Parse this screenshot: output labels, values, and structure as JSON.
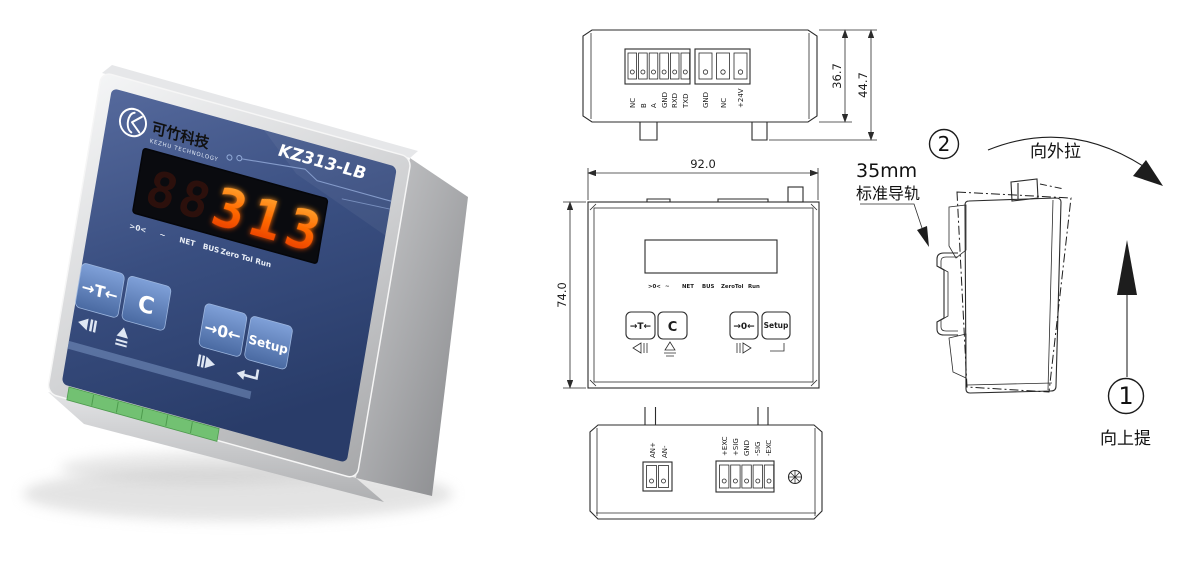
{
  "product": {
    "brand_cn": "可竹科技",
    "brand_en": "KEZHU TECHNOLOGY",
    "model": "KZ313-LB",
    "display_ghost": "88",
    "display_value": "313",
    "indicators": [
      ">0<",
      "~",
      "NET",
      "BUS",
      "Zero Tol",
      "Run"
    ],
    "buttons": {
      "tare": "→T←",
      "clear": "C",
      "zero": "→0←",
      "setup": "Setup"
    }
  },
  "top_view": {
    "terminals_comm": [
      "NC",
      "B",
      "A",
      "GND",
      "RXD",
      "TXD"
    ],
    "terminals_power": [
      "GND",
      "NC",
      "+24V"
    ],
    "dim_body_height": "36.7",
    "dim_total_height": "44.7"
  },
  "front_view": {
    "dim_width": "92.0",
    "dim_height": "74.0",
    "indicators": [
      ">0<",
      "~",
      "NET",
      "BUS",
      "ZeroTol",
      "Run"
    ],
    "buttons": {
      "tare": "→T←",
      "clear": "C",
      "zero": "→0←",
      "setup": "Setup"
    }
  },
  "bottom_view": {
    "terminals_analog": [
      "AN+",
      "AN-"
    ],
    "terminals_loadcell": [
      "+EXC",
      "+SIG",
      "GND",
      "-SIG",
      "-EXC"
    ]
  },
  "install": {
    "rail_label_line1": "35mm",
    "rail_label_line2": "标准导轨",
    "step2_number": "2",
    "step2_text": "向外拉",
    "step1_number": "1",
    "step1_text": "向上提"
  },
  "colors": {
    "panel_blue": "#36497A",
    "button_blue": "#5B82C4",
    "led_red": "#FF5A00",
    "terminal_green": "#72C172",
    "line": "#2B2B2B"
  }
}
